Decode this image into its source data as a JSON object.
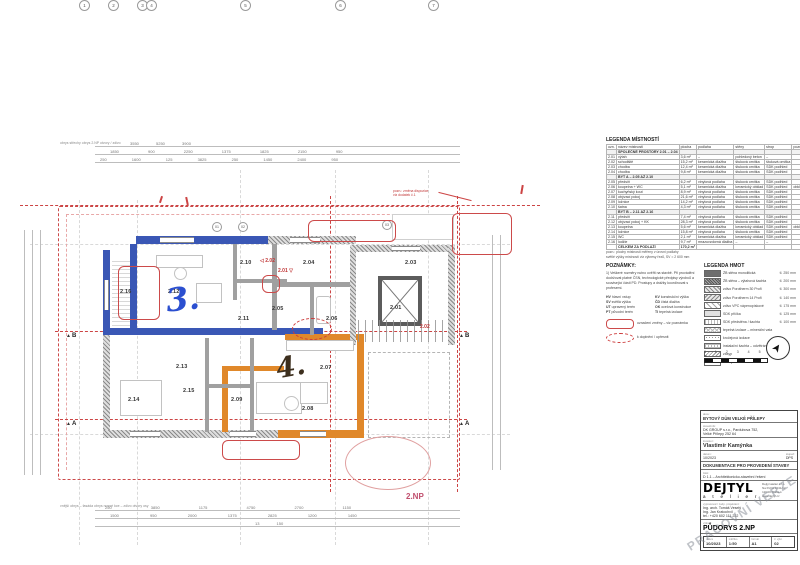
{
  "plan": {
    "floor_label": "2.NP",
    "hand_note_blue": "3.",
    "hand_note_dark": "4.",
    "section_a": "A",
    "section_b": "B",
    "rooms": [
      {
        "id": "2.16",
        "x": 120,
        "y": 289
      },
      {
        "id": "2.12",
        "x": 168,
        "y": 289
      },
      {
        "id": "2.10",
        "x": 240,
        "y": 260
      },
      {
        "id": "2.11",
        "x": 238,
        "y": 316
      },
      {
        "id": "2.04",
        "x": 303,
        "y": 260
      },
      {
        "id": "2.05",
        "x": 272,
        "y": 306
      },
      {
        "id": "2.06",
        "x": 326,
        "y": 316
      },
      {
        "id": "2.03",
        "x": 405,
        "y": 260
      },
      {
        "id": "2.01",
        "x": 390,
        "y": 305
      },
      {
        "id": "2.13",
        "x": 176,
        "y": 364
      },
      {
        "id": "2.15",
        "x": 183,
        "y": 388
      },
      {
        "id": "2.14",
        "x": 128,
        "y": 397
      },
      {
        "id": "2.09",
        "x": 231,
        "y": 397
      },
      {
        "id": "2.07",
        "x": 320,
        "y": 365
      },
      {
        "id": "2.08",
        "x": 302,
        "y": 406
      }
    ],
    "markup": {
      "m1": "2.02",
      "m1_arrow": "◁",
      "m2": "2.01",
      "m2_arrow": "▽",
      "m3": "2.02",
      "note": "pozn.: změna dispozice",
      "note2": "viz dodatek č.1"
    },
    "window_tags": [
      {
        "t": "01",
        "x": 212,
        "y": 222
      },
      {
        "t": "02",
        "x": 238,
        "y": 222
      },
      {
        "t": "03",
        "x": 382,
        "y": 220
      }
    ]
  },
  "dims": {
    "top1": [
      "3550",
      "5250",
      "3900"
    ],
    "top2": [
      "1850",
      "900",
      "2250",
      "1375",
      "1825",
      "2150",
      "950"
    ],
    "top3": [
      "250",
      "1600",
      "125",
      "3825",
      "250",
      "1450",
      "2400",
      "950"
    ],
    "bottom1": [
      "250",
      "3850",
      "1175",
      "4750",
      "2700",
      "1150"
    ],
    "bottom2": [
      "1500",
      "950",
      "2000",
      "1375",
      "2825",
      "1200",
      "1450"
    ],
    "bottom3": [
      "13 150"
    ],
    "top_labels": [
      "obrys střechy",
      "obrys 2.NP",
      "otvory / zdivo"
    ],
    "bottom_labels": [
      "vnější obrys – fasáda",
      "obrys nosné kce – zdivo",
      "otvory",
      "osy"
    ]
  },
  "grid_bubbles": [
    {
      "t": "1",
      "x": 79
    },
    {
      "t": "2",
      "x": 108
    },
    {
      "t": "3",
      "x": 137
    },
    {
      "t": "4",
      "x": 146
    },
    {
      "t": "5",
      "x": 240
    },
    {
      "t": "6",
      "x": 335
    },
    {
      "t": "7",
      "x": 428
    }
  ],
  "legend_rooms": {
    "title": "LEGENDA MÍSTNOSTÍ",
    "headers": [
      "ozn.",
      "název místnosti",
      "plocha",
      "podlaha",
      "stěny",
      "strop",
      "poznámka"
    ],
    "rows": [
      {
        "g": true,
        "c": [
          "",
          "SPOLEČNÉ PROSTORY 2.01 – 2.04",
          "",
          "",
          "",
          "",
          ""
        ]
      },
      {
        "c": [
          "2.01",
          "výtah",
          "3,6 m²",
          "–",
          "pohledový beton",
          "–",
          ""
        ]
      },
      {
        "c": [
          "2.02",
          "schodiště",
          "15,2 m²",
          "keramická dlažba",
          "štuková omítka",
          "štuková omítka",
          ""
        ]
      },
      {
        "c": [
          "2.03",
          "chodba",
          "12,4 m²",
          "keramická dlažba",
          "štuková omítka",
          "SDK podhled",
          ""
        ]
      },
      {
        "c": [
          "2.04",
          "chodba",
          "9,8 m²",
          "keramická dlažba",
          "štuková omítka",
          "SDK podhled",
          ""
        ]
      },
      {
        "g": true,
        "c": [
          "",
          "BYT A – 2.05 AŽ 2.10",
          "",
          "",
          "",
          "",
          ""
        ]
      },
      {
        "c": [
          "2.05",
          "předsíň",
          "6,2 m²",
          "vinylová podlaha",
          "štuková omítka",
          "SDK podhled",
          ""
        ]
      },
      {
        "c": [
          "2.06",
          "koupelna + WC",
          "5,1 m²",
          "keramická dlažba",
          "keramický obklad",
          "SDK podhled",
          "obklad do v. 2100 mm"
        ]
      },
      {
        "c": [
          "2.07",
          "kuchyňský kout",
          "8,9 m²",
          "vinylová podlaha",
          "štuková omítka",
          "SDK podhled",
          ""
        ]
      },
      {
        "c": [
          "2.08",
          "obývací pokoj",
          "21,6 m²",
          "vinylová podlaha",
          "štuková omítka",
          "SDK podhled",
          ""
        ]
      },
      {
        "c": [
          "2.09",
          "ložnice",
          "14,2 m²",
          "vinylová podlaha",
          "štuková omítka",
          "SDK podhled",
          ""
        ]
      },
      {
        "c": [
          "2.10",
          "šatna",
          "4,3 m²",
          "vinylová podlaha",
          "štuková omítka",
          "SDK podhled",
          ""
        ]
      },
      {
        "g": true,
        "c": [
          "",
          "BYT B – 2.11 AŽ 2.16",
          "",
          "",
          "",
          "",
          ""
        ]
      },
      {
        "c": [
          "2.11",
          "předsíň",
          "7,4 m²",
          "vinylová podlaha",
          "štuková omítka",
          "SDK podhled",
          ""
        ]
      },
      {
        "c": [
          "2.12",
          "obývací pokoj + KK",
          "28,3 m²",
          "vinylová podlaha",
          "štuková omítka",
          "SDK podhled",
          ""
        ]
      },
      {
        "c": [
          "2.13",
          "koupelna",
          "5,6 m²",
          "keramická dlažba",
          "keramický obklad",
          "SDK podhled",
          "obklad do v. 2100 mm"
        ]
      },
      {
        "c": [
          "2.14",
          "ložnice",
          "15,8 m²",
          "vinylová podlaha",
          "štuková omítka",
          "SDK podhled",
          ""
        ]
      },
      {
        "c": [
          "2.15",
          "WC",
          "2,1 m²",
          "keramická dlažba",
          "keramický obklad",
          "SDK podhled",
          ""
        ]
      },
      {
        "c": [
          "2.16",
          "lodžie",
          "9,7 m²",
          "mrazuvzdorná dlažba",
          "–",
          "–",
          ""
        ]
      },
      {
        "total": true,
        "c": [
          "",
          "CELKEM ZA PODLAŽÍ",
          "170,2 m²",
          "",
          "",
          "",
          ""
        ]
      }
    ],
    "footnotes": [
      "pozn.: plochy místností měřeny v úrovni podlahy",
      "světlé výšky místností viz výkresy řezů, SV = 2 600 mm"
    ]
  },
  "notes": {
    "title": "POZNÁMKY:",
    "note1": "1) Veškeré rozměry nutno ověřit na stavbě. Při provádění dodržovat platné ČSN, technologické předpisy výrobců a související části PD. Prostupy a drážky koordinovat s profesemi.",
    "abbr_left": [
      {
        "k": "HV",
        "v": "hlavní vstup"
      },
      {
        "k": "SV",
        "v": "světlá výška"
      },
      {
        "k": "UT",
        "v": "upravený terén"
      },
      {
        "k": "PT",
        "v": "původní terén"
      }
    ],
    "abbr_right": [
      {
        "k": "KV",
        "v": "konstrukční výška"
      },
      {
        "k": "ČD",
        "v": "čistá dlažba"
      },
      {
        "k": "OK",
        "v": "ocelová konstrukce"
      },
      {
        "k": "TI",
        "v": "tepelná izolace"
      }
    ],
    "mark_rect": "označení změny – viz poznámka",
    "mark_cloud": "k doplnění / upřesnit"
  },
  "materials": {
    "title": "LEGENDA HMOT",
    "rows": [
      {
        "sw": "sdark",
        "label": "ŽB stěna monolitická",
        "val": "tl. 250 mm"
      },
      {
        "sw": "sdark2",
        "label": "ŽB stěna – výtahová šachta",
        "val": "tl. 200 mm"
      },
      {
        "sw": "sbrick",
        "label": "zdivo Porotherm 30 Profi",
        "val": "tl. 300 mm"
      },
      {
        "sw": "sbrick2",
        "label": "zdivo Porotherm 14 Profi",
        "val": "tl. 140 mm"
      },
      {
        "sw": "sdiag",
        "label": "zdivo VPC vápenopískové",
        "val": "tl. 175 mm"
      },
      {
        "sw": "slight",
        "label": "SDK příčka",
        "val": "tl. 125 mm"
      },
      {
        "sw": "slight2",
        "label": "SDK předstěna / šachta",
        "val": "tl. 100 mm"
      },
      {
        "sw": "scross",
        "label": "tepelná izolace – minerální vata",
        "val": ""
      },
      {
        "sw": "sdots",
        "label": "kročejová izolace",
        "val": ""
      },
      {
        "sw": "sgrid",
        "label": "instalační šachta – odvětrání",
        "val": ""
      },
      {
        "sw": "szig",
        "label": "zásyp",
        "val": ""
      },
      {
        "sw": "sblank",
        "label": "stávající konstrukce",
        "val": ""
      }
    ]
  },
  "scalebar": {
    "nums": [
      "0",
      "1",
      "2",
      "3",
      "4",
      "5 m"
    ]
  },
  "compass": {
    "needle": "➤"
  },
  "title_block": {
    "akce_label": "akce:",
    "akce": "BYTOVÝ DŮM VELKÉ PŘÍLEPY",
    "stavebnik_label": "stavebník:",
    "stavebnik1": "DK GROUP s.r.o., Pardubova 752,",
    "stavebnik2": "Velké Přílepy 252 64",
    "investor_label": "investor:",
    "investor": "Vlastimír Kamýnka",
    "datum_label": "datum:",
    "datum": "10/2023",
    "stupen_label": "stupeň:",
    "stupen": "DPS",
    "stage": "DOKUMENTACE PRO PROVEDENÍ STAVBY",
    "part_label": "část:",
    "part": "D 1.1 – Architektonicko-stavební řešení",
    "logo_main": "DEJTYL",
    "logo_sub": "a t e l i e r",
    "logo_addr": [
      "Dejtyl atelier s.r.o.",
      "Na Poříčí 1041/12",
      "110 00 Praha 1",
      "www.dejtyl.cz"
    ],
    "designer_label": "vypracoval / zodp. projektant:",
    "designers": [
      "Ing. arch. Tomáš Veselý",
      "Ing. Jan Kratochvíl",
      "tel.: +420 602 111 222"
    ],
    "vykres_label": "výkres:",
    "drawing_title": "PŮDORYS 2.NP",
    "footer": [
      {
        "lab": "datum",
        "v": "10/2023"
      },
      {
        "lab": "měřítko",
        "v": "1:50"
      },
      {
        "lab": "formát",
        "v": "A1"
      },
      {
        "lab": "č. výkr.",
        "v": "02"
      }
    ],
    "watermark": "PRACOVNÍ VERZE"
  }
}
